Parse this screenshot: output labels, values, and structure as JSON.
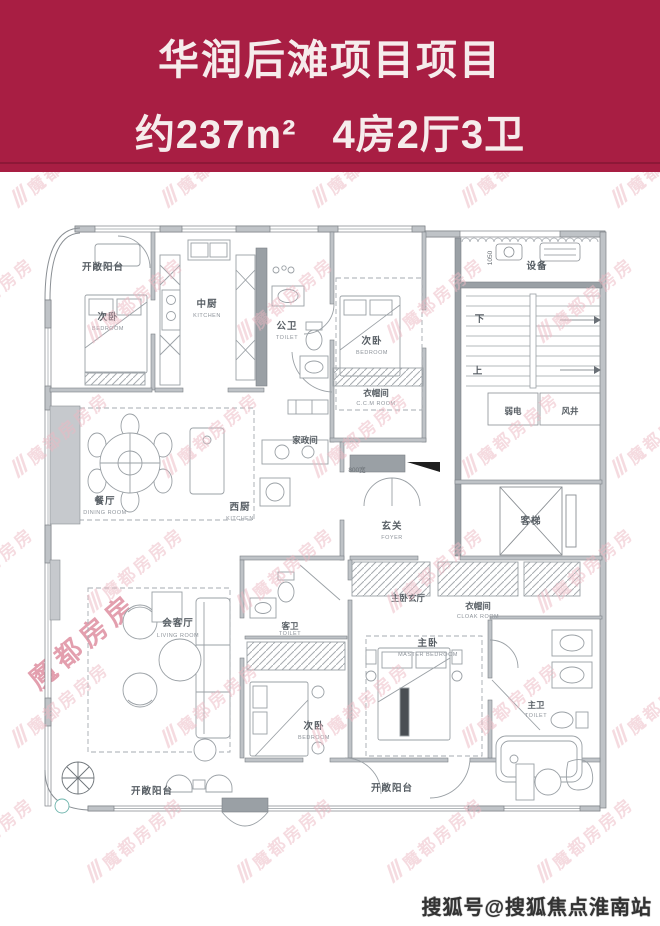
{
  "header": {
    "line1": "华润后滩项目项目",
    "line2_area": "约237m²",
    "line2_rooms": "4房2厅3卫"
  },
  "colors": {
    "header_bg": "#a81e43",
    "header_divider": "#8d1837",
    "header_text": "#f6ecec",
    "plan_line": "#8a8f94",
    "wall_fill": "#bfc3c7",
    "wall_dark": "#9aa0a5",
    "watermark_pink": "#edb9c3",
    "footer_text": "#333333"
  },
  "plan": {
    "labels": {
      "balcony_top": "开敞阳台",
      "bedroom_tl": "次卧",
      "bedroom_tl_en": "BEDROOM",
      "kitchen_main": "中厨",
      "kitchen_main_en": "KITCHEN",
      "toilet_public": "公卫",
      "toilet_public_en": "TOILET",
      "bedroom_tr": "次卧",
      "bedroom_tr_en": "BEDROOM",
      "cloak_top": "衣帽间",
      "cloak_top_en": "C.C.M ROOM",
      "equipment": "设备",
      "down": "下",
      "up": "上",
      "low_voltage": "弱电",
      "air_shaft": "风井",
      "dining": "餐厅",
      "dining_en": "DINING ROOM",
      "kitchen_west": "西厨",
      "kitchen_west_en": "KITCHEN",
      "housekeeping": "家政间",
      "foyer": "玄关",
      "foyer_en": "FOYER",
      "elevator": "客梯",
      "living": "会客厅",
      "living_en": "LIVING ROOM",
      "toilet_guest": "客卫",
      "toilet_guest_en": "TOILET",
      "bedroom_b": "次卧",
      "bedroom_b_en": "BEDROOM",
      "master_foyer": "主卧玄厅",
      "cloak_master": "衣帽间",
      "cloak_master_en": "CLOAK ROOM",
      "master": "主卧",
      "master_en": "MASTER BEDROOM",
      "master_bath": "主卫",
      "master_bath_en": "TOILET",
      "balcony_bl": "开敞阳台",
      "balcony_br": "开敞阳台"
    },
    "dims": {
      "w800": "800宽",
      "h1050": "1050"
    }
  },
  "watermark": {
    "slashes": "///",
    "text": "魔都房房房",
    "corner_text": "魔都房房"
  },
  "footer": {
    "credit": "搜狐号@搜狐焦点淮南站"
  }
}
